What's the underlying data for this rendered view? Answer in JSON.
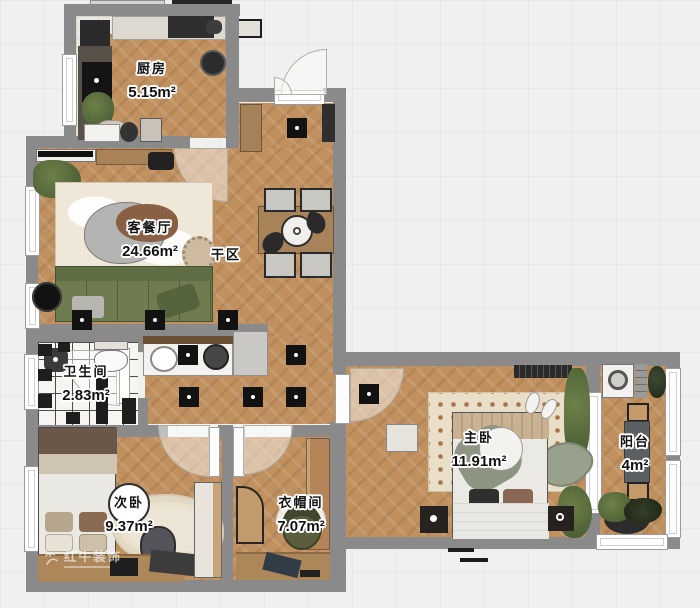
{
  "document": {
    "kind": "residential floor plan rendering"
  },
  "rooms": [
    {
      "id": "kitchen",
      "label": "厨房",
      "area": "5.15m²"
    },
    {
      "id": "living-dining",
      "label": "客餐厅",
      "area": "24.66m²"
    },
    {
      "id": "dry-zone",
      "label": "干区",
      "area": ""
    },
    {
      "id": "bathroom",
      "label": "卫生间",
      "area": "2.83m²"
    },
    {
      "id": "second-bedroom",
      "label": "次卧",
      "area": "9.37m²"
    },
    {
      "id": "cloakroom",
      "label": "衣帽间",
      "area": "7.07m²"
    },
    {
      "id": "master-bedroom",
      "label": "主卧",
      "area": "11.91m²"
    },
    {
      "id": "balcony",
      "label": "阳台",
      "area": "4m²"
    }
  ],
  "watermark": {
    "text": "红牛装饰"
  },
  "colors": {
    "wall": "#8a8a8a",
    "wood_floor": "#c0905f",
    "kitchen_tile": "#ebe7e1",
    "bath_tile": "#f7f5f2",
    "sofa_green": "#6e7c50",
    "label_text": "#111111",
    "label_stroke": "#ffffff",
    "light_fixture": "#121212"
  }
}
